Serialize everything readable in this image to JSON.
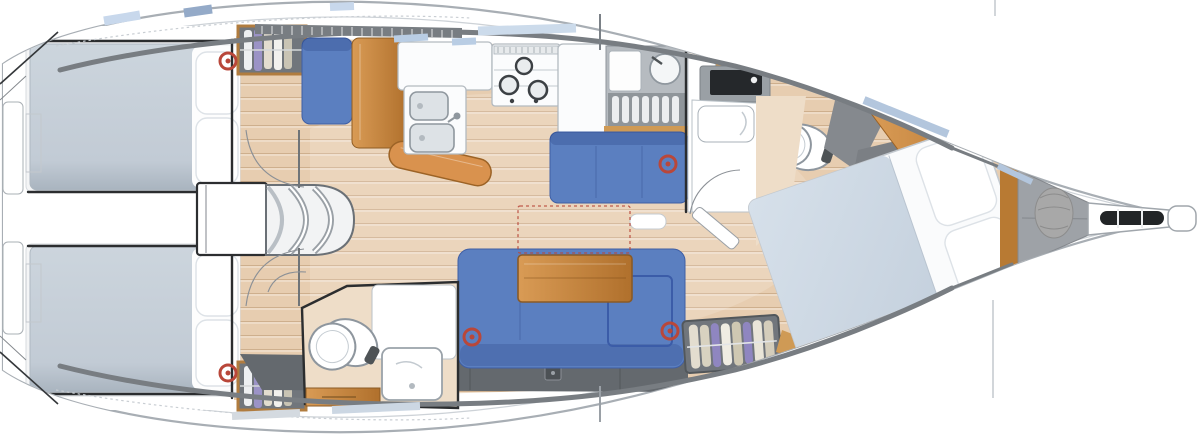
{
  "vessel": {
    "view": "overhead-interior-floor-plan",
    "orientation": "bow-right"
  },
  "palette": {
    "hull_line": "#a8aeb4",
    "inner_line": "#cdd2d7",
    "coachroof": "#787d82",
    "locker_gray": "#64696e",
    "wall": "#2b2d2f",
    "wood_floor": "#e7cdb0",
    "wood_floor_light": "#f0ddc4",
    "wood_mid": "#cf9a55",
    "wood_dark": "#b87a33",
    "wood_table": "#c08447",
    "cushion_blue": "#5b7fc0",
    "cushion_dark": "#3a57a0",
    "mattress_gray": "#c5ced7",
    "duvet_blue": "#cdd8e4",
    "beige_floor": "#eeddc8",
    "gray_panel": "#94989d",
    "wardrobe_gray": "#71767c",
    "counter_white": "#fbfcfd",
    "counter_line": "#b3bac0",
    "sink_gray": "#dde2e6",
    "toilet_line": "#8e969e",
    "marker_red": "#b9473a",
    "hatch_blue": "#c8d8ec",
    "hatch_blue_dark": "#94aac8",
    "pouf_gray": "#a8a8a8",
    "bow_gray": "#9ea2a7"
  },
  "features": [
    {
      "id": "aft-cabin-top",
      "label": "aft cabin with double berth and hanging locker"
    },
    {
      "id": "aft-cabin-bottom",
      "label": "aft cabin with double berth and hanging locker"
    },
    {
      "id": "companionway-steps",
      "label": "companionway steps over engine box"
    },
    {
      "id": "nav-station",
      "label": "chart table with seat"
    },
    {
      "id": "galley",
      "label": "galley: double sink, 3-burner stove, fridge, drainer"
    },
    {
      "id": "dinette-bench",
      "label": "settee bench forward of galley"
    },
    {
      "id": "saloon-settee",
      "label": "L-shaped settee with folding saloon table"
    },
    {
      "id": "aft-heads",
      "label": "aft heads: toilet, basin, shower"
    },
    {
      "id": "forward-heads",
      "label": "forward heads: vanity and toilet"
    },
    {
      "id": "owners-cabin",
      "label": "forward cabin with island double berth"
    },
    {
      "id": "anchor-locker",
      "label": "bow locker with rode bag"
    },
    {
      "id": "bow-fitting",
      "label": "stem fitting with anchor roller"
    },
    {
      "id": "table-extension-outline",
      "label": "dashed outline of optional table extension"
    },
    {
      "id": "ring-markers",
      "label": "five red ring markers on cushions"
    }
  ]
}
